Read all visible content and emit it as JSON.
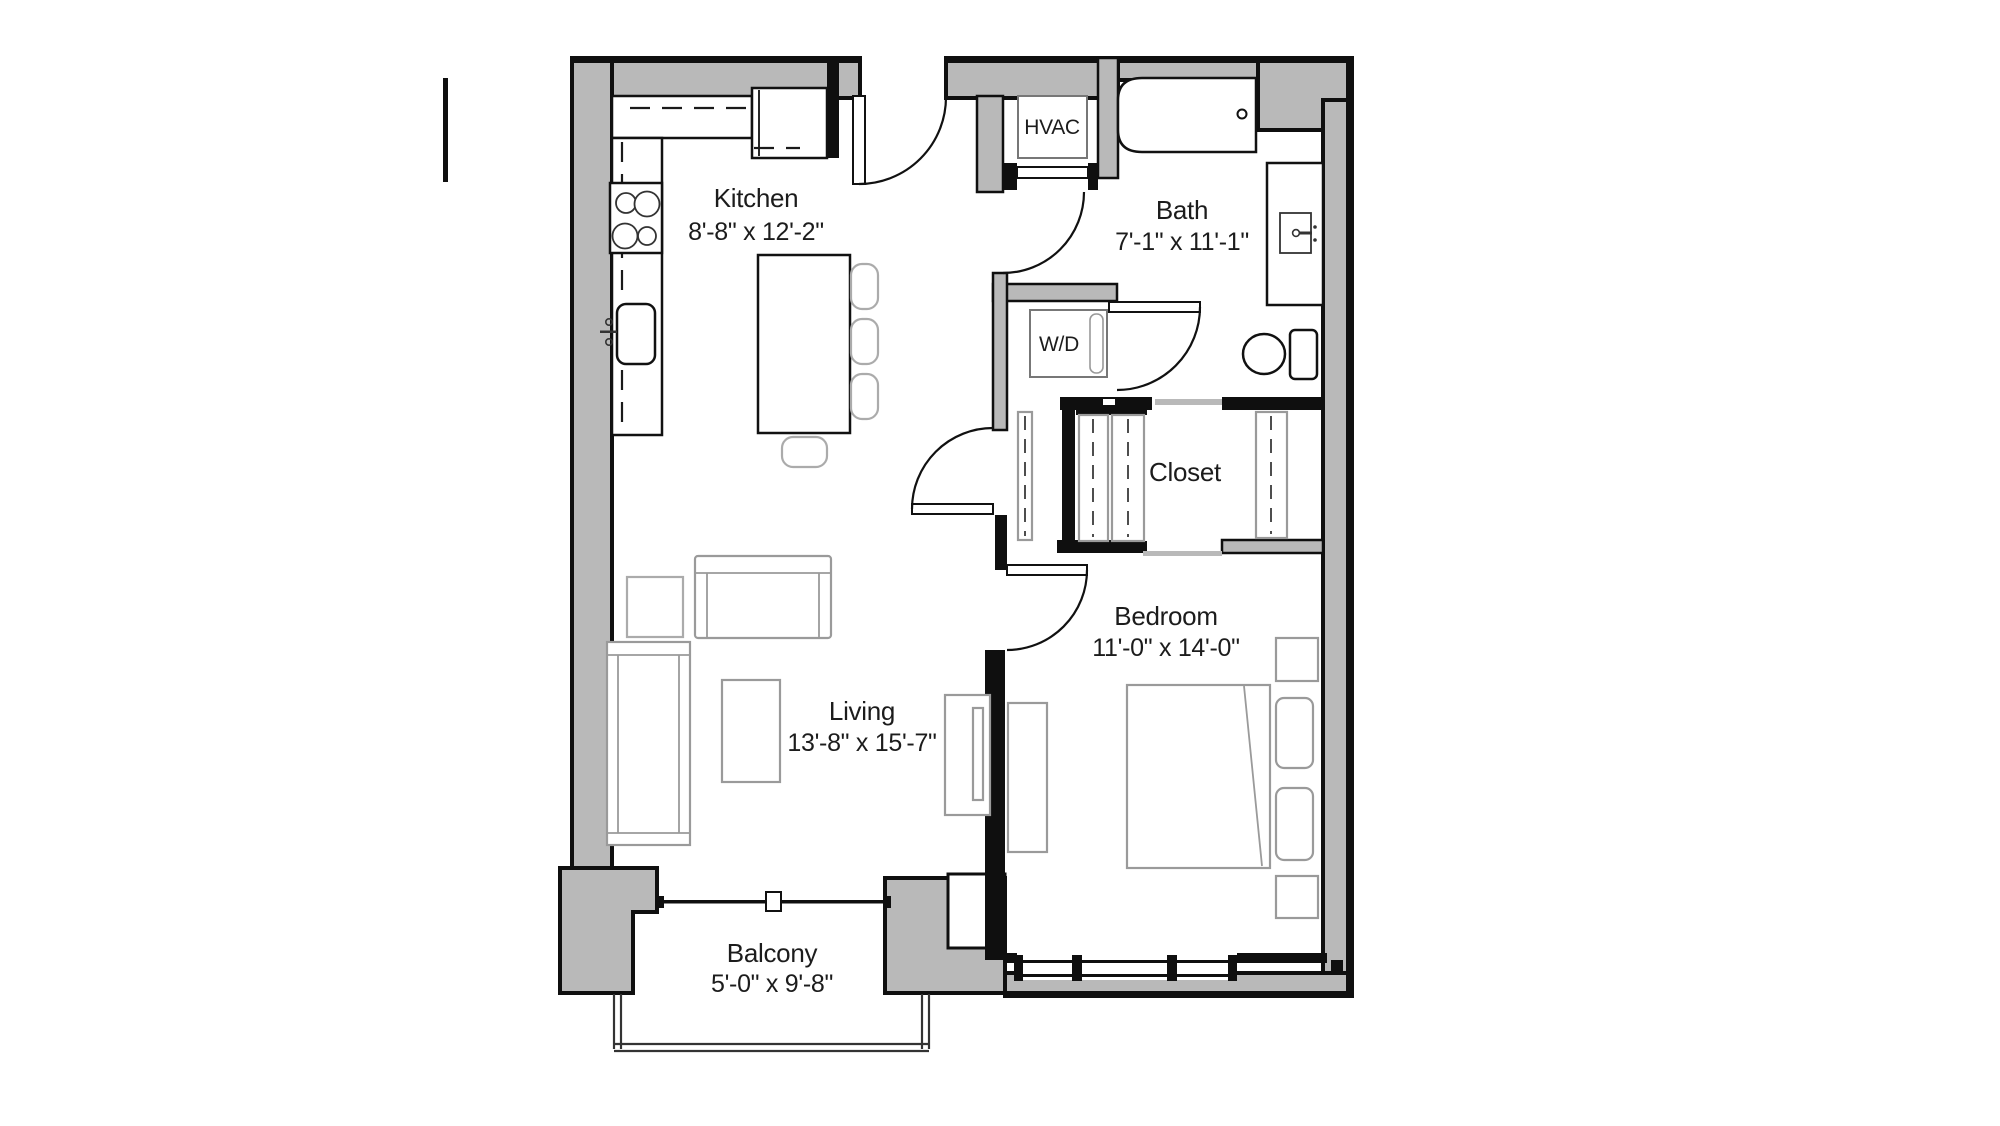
{
  "floorplan": {
    "rooms": {
      "kitchen": {
        "label": "Kitchen",
        "dims": "8'-8\" x 12'-2\""
      },
      "bath": {
        "label": "Bath",
        "dims": "7'-1\" x 11'-1\""
      },
      "closet": {
        "label": "Closet"
      },
      "bedroom": {
        "label": "Bedroom",
        "dims": "11'-0\" x 14'-0\""
      },
      "living": {
        "label": "Living",
        "dims": "13'-8\" x 15'-7\""
      },
      "balcony": {
        "label": "Balcony",
        "dims": "5'-0\" x 9'-8\""
      }
    },
    "equipment": {
      "hvac": {
        "label": "HVAC"
      },
      "washer_dryer": {
        "label": "W/D"
      }
    },
    "colors": {
      "wall_fill": "#b9b9b9",
      "line": "#111111",
      "furniture_line": "#9a9a9a"
    }
  }
}
